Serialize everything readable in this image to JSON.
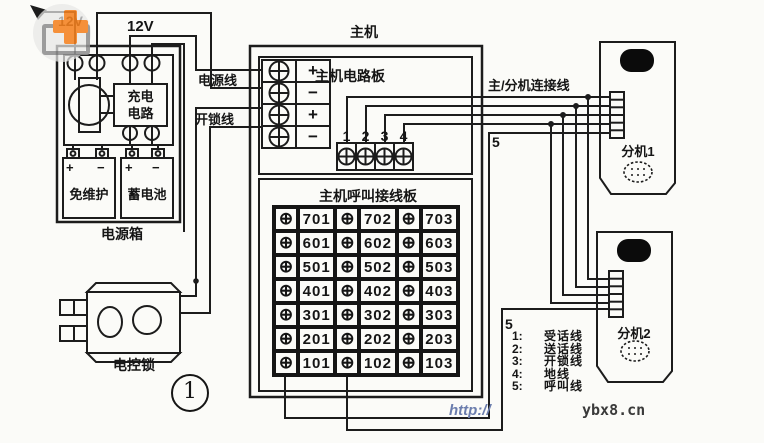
{
  "colors": {
    "ink": "#1c1c1c",
    "paper": "#fbfbf8",
    "logo_orange": "#f58220",
    "url_blue": "#6b7dad"
  },
  "symbols": {
    "terminal": "⊕"
  },
  "power_section": {
    "supply_12v_left": "12V",
    "supply_12v": "12V",
    "charge_circuit_line1": "充电",
    "charge_circuit_line2": "电路",
    "battery1_label": "免维护",
    "battery2_label": "蓄电池",
    "battery1_polarity": [
      "+",
      "−"
    ],
    "battery2_polarity": [
      "+",
      "−"
    ],
    "box_label": "电源箱"
  },
  "wires": {
    "power_line": "电源线",
    "unlock_line": "开锁线",
    "connect_line": "主/分机连接线",
    "wire5_top": "5",
    "wire5_bottom": "5"
  },
  "main_unit": {
    "title": "主机",
    "board_label": "主机电路板",
    "call_board_label": "主机呼叫接线板",
    "input_polarity": [
      "+",
      "−",
      "+",
      "−"
    ],
    "plug_numbers": [
      "1",
      "2",
      "3",
      "4"
    ]
  },
  "call_board_rows": [
    [
      "701",
      "702",
      "703"
    ],
    [
      "601",
      "602",
      "603"
    ],
    [
      "501",
      "502",
      "503"
    ],
    [
      "401",
      "402",
      "403"
    ],
    [
      "301",
      "302",
      "303"
    ],
    [
      "201",
      "202",
      "203"
    ],
    [
      "101",
      "102",
      "103"
    ]
  ],
  "handsets": {
    "handset1_label": "分机1",
    "handset2_label": "分机2"
  },
  "legend": [
    {
      "num": "1:",
      "label": "受话线"
    },
    {
      "num": "2:",
      "label": "送话线"
    },
    {
      "num": "3:",
      "label": "开锁线"
    },
    {
      "num": "4:",
      "label": "地线"
    },
    {
      "num": "5:",
      "label": "呼叫线"
    }
  ],
  "lock_label": "电控锁",
  "figure_number": "1",
  "watermark": {
    "url_http": "http://",
    "url_domain": "ybx8.cn"
  }
}
